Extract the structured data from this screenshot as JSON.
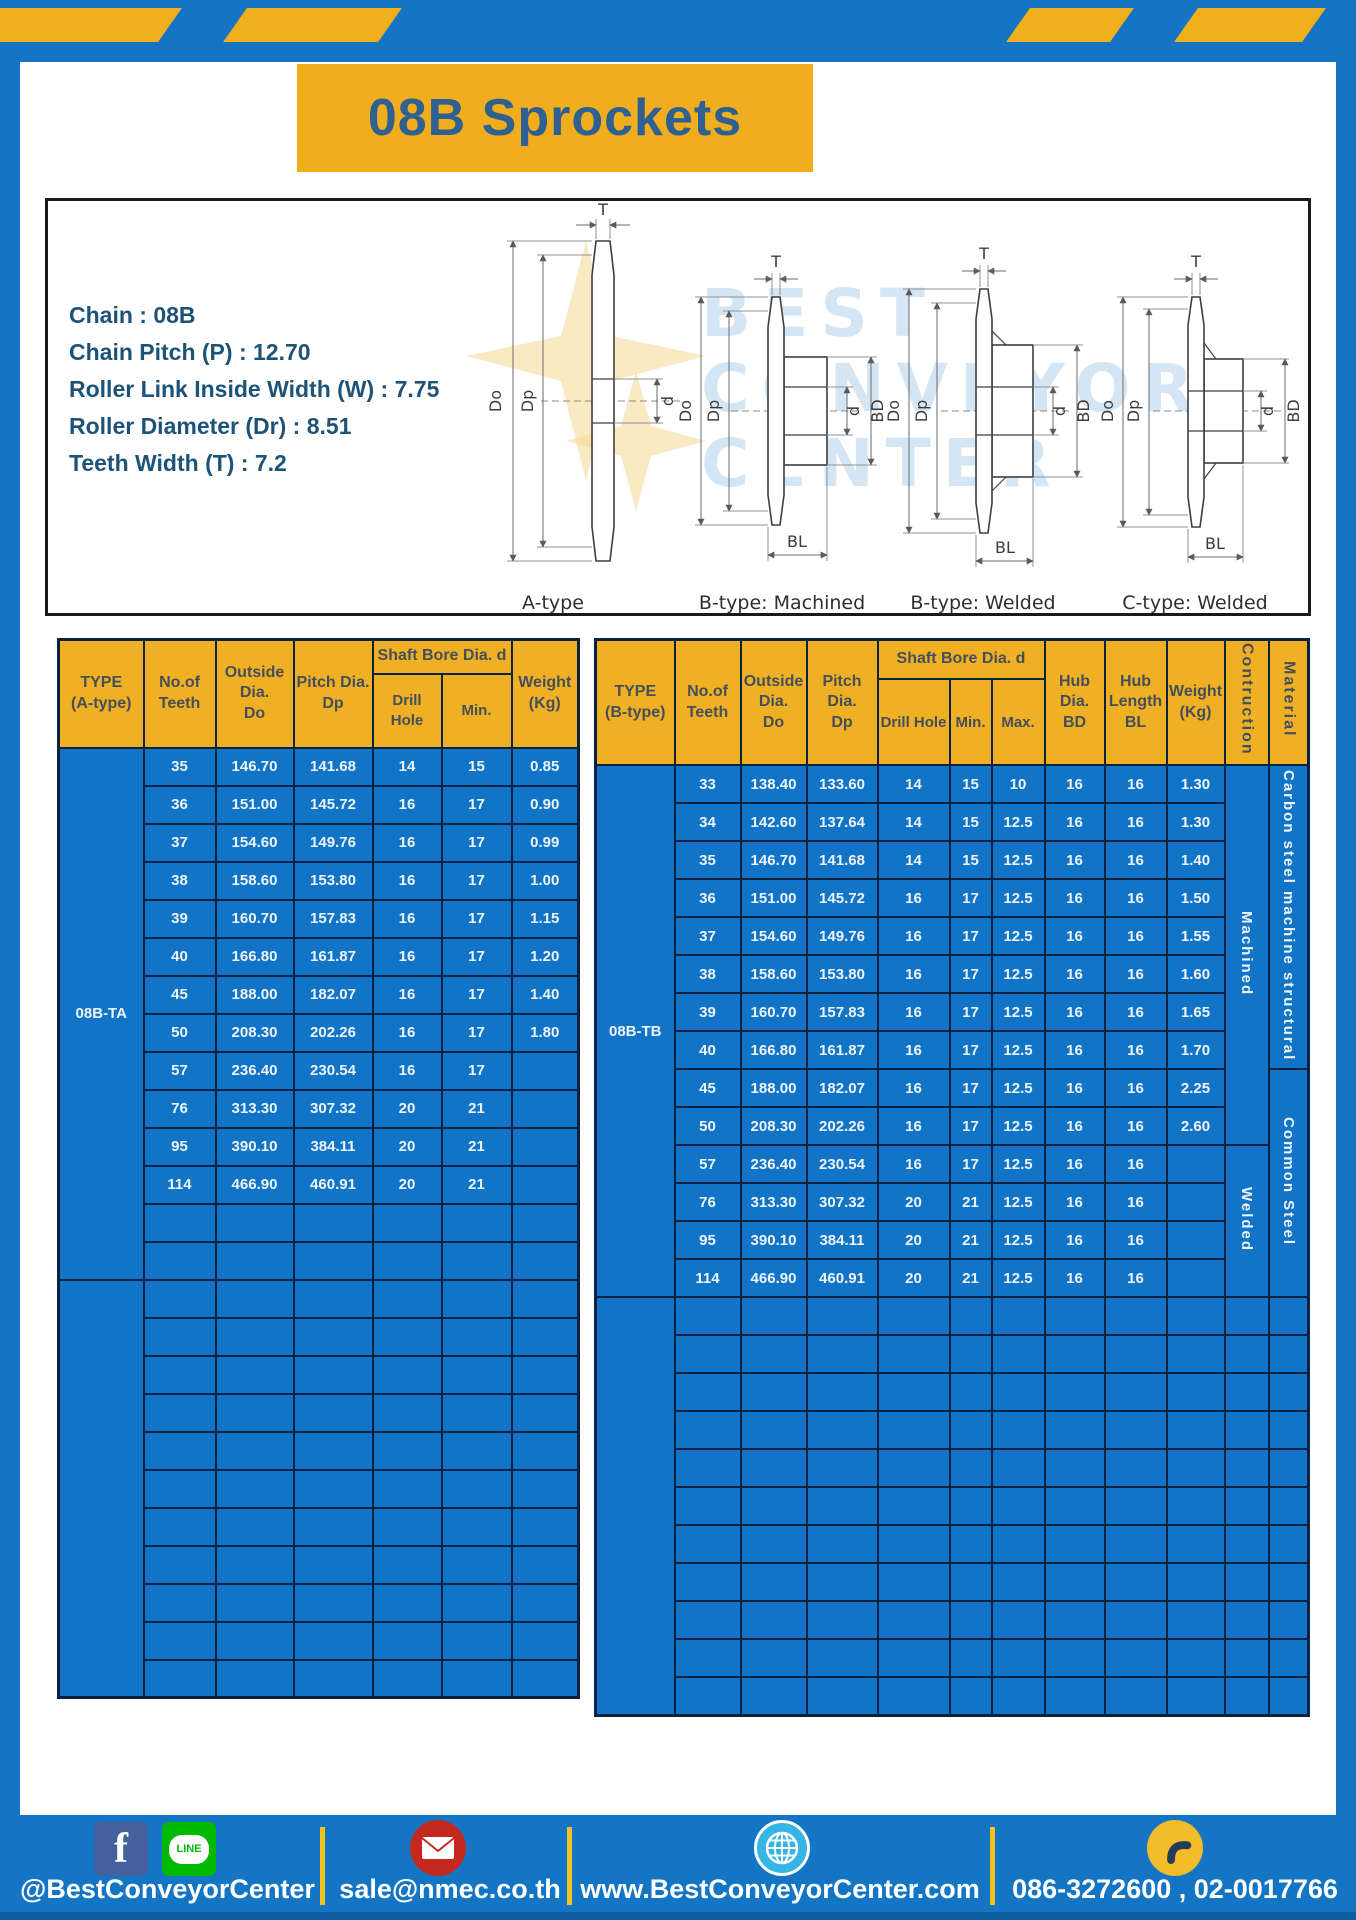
{
  "title": "08B Sprockets",
  "specs": {
    "lines": [
      "Chain : 08B",
      "Chain Pitch (P) : 12.70",
      "Roller Link Inside Width (W) : 7.75",
      "Roller Diameter (Dr) : 8.51",
      "Teeth Width (T) : 7.2"
    ]
  },
  "diagram": {
    "type_labels": [
      "A-type",
      "B-type: Machined",
      "B-type: Welded",
      "C-type: Welded"
    ],
    "dim_labels": {
      "teeth_width": "T",
      "outside_dia": "Do",
      "pitch_dia": "Dp",
      "bore": "d",
      "hub_dia": "BD",
      "hub_length": "BL"
    },
    "watermark": [
      "BEST",
      "CONVEYOR",
      "CENTER"
    ]
  },
  "left_table": {
    "headers": {
      "type": "TYPE\n(A-type)",
      "teeth": "No.of\nTeeth",
      "outside": "Outside\nDia.\nDo",
      "pitch": "Pitch Dia.\nDp",
      "shaft_bore": "Shaft Bore Dia. d",
      "drill": "Drill Hole",
      "min": "Min.",
      "weight": "Weight\n(Kg)"
    },
    "type_label": "08B-TA",
    "rows": [
      [
        "35",
        "146.70",
        "141.68",
        "14",
        "15",
        "0.85"
      ],
      [
        "36",
        "151.00",
        "145.72",
        "16",
        "17",
        "0.90"
      ],
      [
        "37",
        "154.60",
        "149.76",
        "16",
        "17",
        "0.99"
      ],
      [
        "38",
        "158.60",
        "153.80",
        "16",
        "17",
        "1.00"
      ],
      [
        "39",
        "160.70",
        "157.83",
        "16",
        "17",
        "1.15"
      ],
      [
        "40",
        "166.80",
        "161.87",
        "16",
        "17",
        "1.20"
      ],
      [
        "45",
        "188.00",
        "182.07",
        "16",
        "17",
        "1.40"
      ],
      [
        "50",
        "208.30",
        "202.26",
        "16",
        "17",
        "1.80"
      ],
      [
        "57",
        "236.40",
        "230.54",
        "16",
        "17",
        ""
      ],
      [
        "76",
        "313.30",
        "307.32",
        "20",
        "21",
        ""
      ],
      [
        "95",
        "390.10",
        "384.11",
        "20",
        "21",
        ""
      ],
      [
        "114",
        "466.90",
        "460.91",
        "20",
        "21",
        ""
      ],
      [
        "",
        "",
        "",
        "",
        "",
        ""
      ],
      [
        "",
        "",
        "",
        "",
        "",
        ""
      ]
    ],
    "empty_bottom_rows": 11
  },
  "right_table": {
    "headers": {
      "type": "TYPE\n(B-type)",
      "teeth": "No.of\nTeeth",
      "outside": "Outside\nDia.\nDo",
      "pitch": "Pitch Dia.\nDp",
      "shaft_bore": "Shaft Bore Dia. d",
      "drill": "Drill Hole",
      "min": "Min.",
      "max": "Max.",
      "hub_dia": "Hub Dia.\nBD",
      "hub_length": "Hub\nLength\nBL",
      "weight": "Weight\n(Kg)",
      "construction": "Contruction",
      "material": "Material"
    },
    "type_label": "08B-TB",
    "rows": [
      [
        "33",
        "138.40",
        "133.60",
        "14",
        "15",
        "10",
        "16",
        "16",
        "1.30"
      ],
      [
        "34",
        "142.60",
        "137.64",
        "14",
        "15",
        "12.5",
        "16",
        "16",
        "1.30"
      ],
      [
        "35",
        "146.70",
        "141.68",
        "14",
        "15",
        "12.5",
        "16",
        "16",
        "1.40"
      ],
      [
        "36",
        "151.00",
        "145.72",
        "16",
        "17",
        "12.5",
        "16",
        "16",
        "1.50"
      ],
      [
        "37",
        "154.60",
        "149.76",
        "16",
        "17",
        "12.5",
        "16",
        "16",
        "1.55"
      ],
      [
        "38",
        "158.60",
        "153.80",
        "16",
        "17",
        "12.5",
        "16",
        "16",
        "1.60"
      ],
      [
        "39",
        "160.70",
        "157.83",
        "16",
        "17",
        "12.5",
        "16",
        "16",
        "1.65"
      ],
      [
        "40",
        "166.80",
        "161.87",
        "16",
        "17",
        "12.5",
        "16",
        "16",
        "1.70"
      ],
      [
        "45",
        "188.00",
        "182.07",
        "16",
        "17",
        "12.5",
        "16",
        "16",
        "2.25"
      ],
      [
        "50",
        "208.30",
        "202.26",
        "16",
        "17",
        "12.5",
        "16",
        "16",
        "2.60"
      ],
      [
        "57",
        "236.40",
        "230.54",
        "16",
        "17",
        "12.5",
        "16",
        "16",
        ""
      ],
      [
        "76",
        "313.30",
        "307.32",
        "20",
        "21",
        "12.5",
        "16",
        "16",
        ""
      ],
      [
        "95",
        "390.10",
        "384.11",
        "20",
        "21",
        "12.5",
        "16",
        "16",
        ""
      ],
      [
        "114",
        "466.90",
        "460.91",
        "20",
        "21",
        "12.5",
        "16",
        "16",
        ""
      ]
    ],
    "construction_groups": [
      {
        "label": "Machined",
        "rows": 10
      },
      {
        "label": "Welded",
        "rows": 4
      }
    ],
    "material_groups": [
      {
        "label": "Carbon steel machine structural",
        "rows": 8
      },
      {
        "label": "Common Steel",
        "rows": 6
      }
    ],
    "empty_bottom_rows": 11
  },
  "footer": {
    "social_handle": "@BestConveyorCenter",
    "line_label": "LINE",
    "facebook_glyph": "f",
    "email": "sale@nmec.co.th",
    "website": "www.BestConveyorCenter.com",
    "phones": "086-3272600 , 02-0017766"
  },
  "colors": {
    "frame_blue": "#1375c4",
    "stripe_yellow": "#f0b01e",
    "title_box_yellow": "#f0ad1d",
    "title_text_blue": "#2e6091",
    "spec_text_blue": "#1d5378",
    "table_header_yellow": "#f0b024",
    "table_cell_blue": "#1174c6",
    "grid_navy": "#0a2240",
    "footer_divider_yellow": "#f2c21e"
  }
}
